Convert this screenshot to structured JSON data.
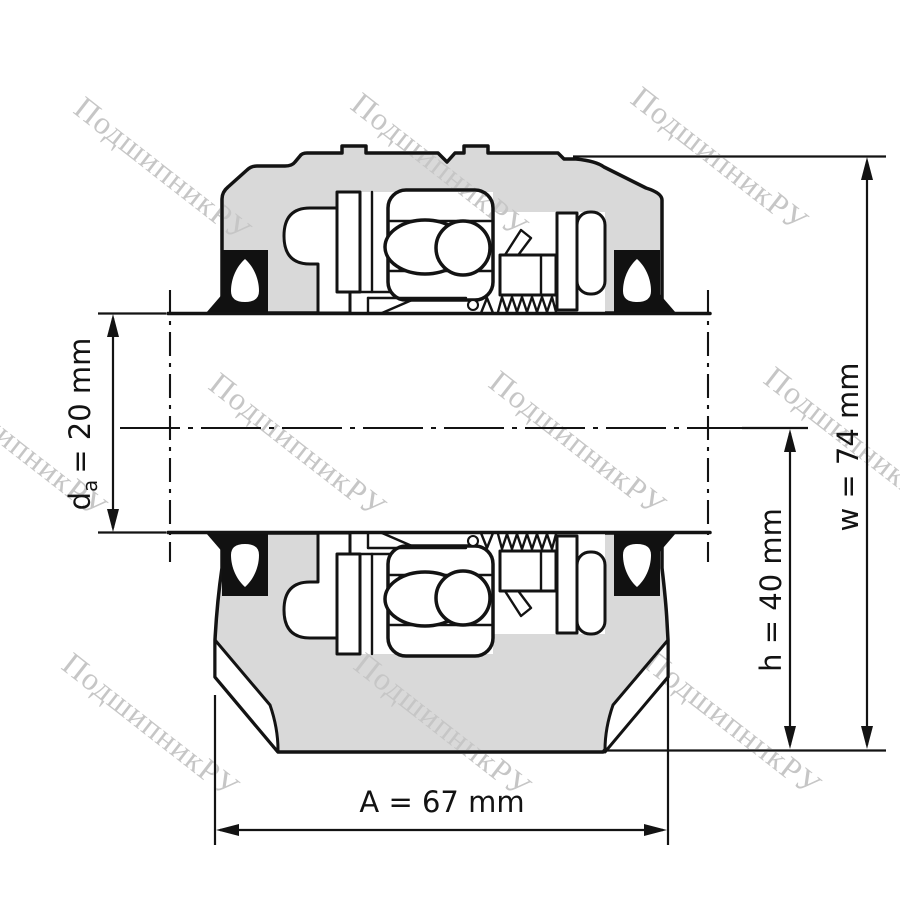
{
  "watermark": {
    "text": "ПодшипникРУ"
  },
  "dimensions": {
    "bore_diameter": {
      "symbol": "d",
      "subscript": "a",
      "value": "= 20 mm"
    },
    "center_height": {
      "label": "h = 40 mm"
    },
    "housing_height": {
      "label": "w = 74 mm"
    },
    "base_length": {
      "label": "A = 67 mm"
    }
  },
  "colors": {
    "line": "#131313",
    "housing_fill": "#d9d9d9",
    "seal_fill": "#111111",
    "background": "#ffffff",
    "watermark": "#c6c6c6"
  }
}
